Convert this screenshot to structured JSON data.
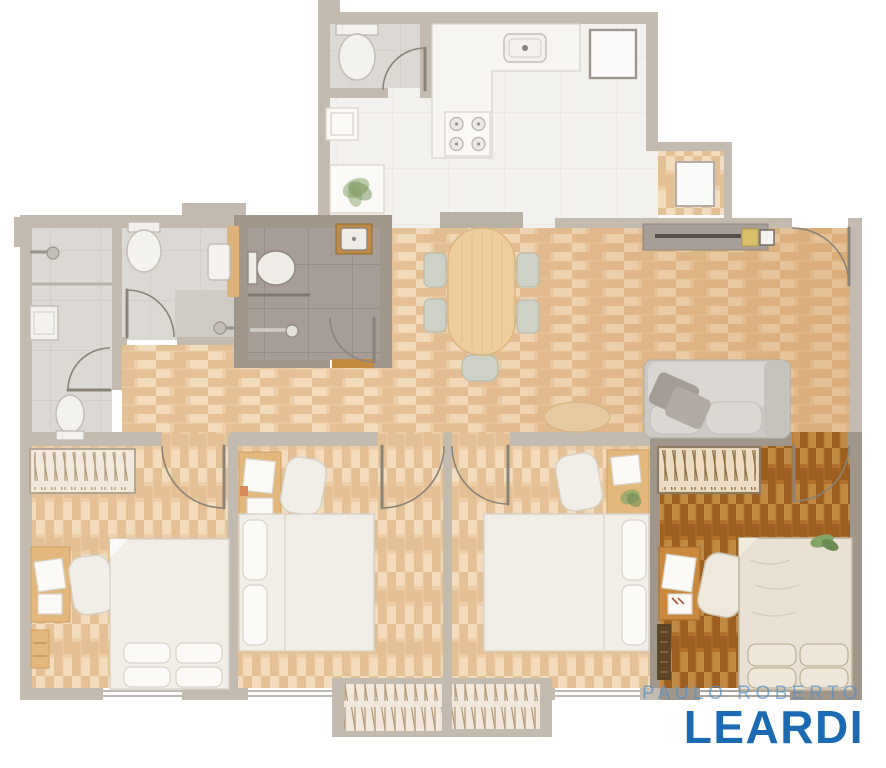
{
  "watermark": {
    "line1": "PAULO ROBERTO",
    "line2": "LEARDI"
  },
  "palette": {
    "background": "#ffffff",
    "wall_light": "#c3bbb0",
    "wall_dark": "#a0968a",
    "wood_base": "#eccfa9",
    "wood_dark": "#e4c097",
    "wood_light": "#f2dcbd",
    "wood_hi_base": "#b1712d",
    "wood_hi_dark": "#9d5f1f",
    "wood_hi_light": "#c08a44",
    "tile_light": "#dcd9d4",
    "tile_light_line": "#ccc8c2",
    "tile_mid": "#cfcbc5",
    "tile_dark": "#a69e96",
    "tile_dark_line": "#918981",
    "kitchen_floor": "#f3f1ee",
    "kitchen_floor_line": "#e7e4df",
    "furn_white": "#f1eee8",
    "furn_stroke": "#d8d2c8",
    "wood_furn": "#e2b87c",
    "wood_furn_dark": "#c9883b",
    "chair_sage": "#ced2c6",
    "sofa_base": "#cdcac5",
    "sofa_cushion": "#dad7d2",
    "pillow_dark": "#a49d96",
    "console_gray": "#a79f97",
    "tv_dark": "#55504a",
    "gold": "#d9c06a",
    "plant_green": "#85a468",
    "plant_green_dark": "#6c8b52",
    "threshold": "#c3893f",
    "dark_item": "#5d4327",
    "outline": "#8b8378",
    "window_line": "#aaa29a",
    "watermark_light": "#5791c7",
    "watermark_blue": "#1b6ab2"
  }
}
